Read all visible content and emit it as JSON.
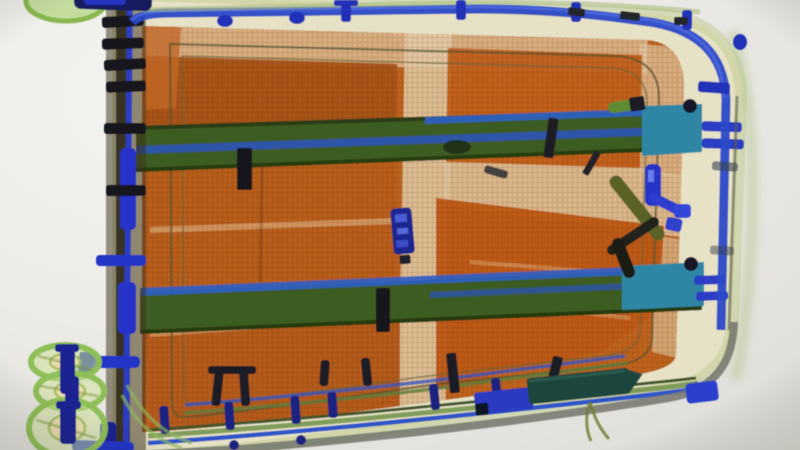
{
  "meta": {
    "scene": "airport-security-xray-baggage-scan",
    "description": "False-color X-ray photograph of a rolling suitcase packed with organic (orange) contents, metal telescopic handle rails, spinner wheels and small metal hardware items",
    "visible_text": []
  },
  "palette": {
    "background": "#edecea",
    "shell_beige": "#e7e2c6",
    "organic_orange": "#c0631f",
    "organic_orange_dark": "#a85418",
    "organic_orange_bright": "#bf5a16",
    "band_light": "#e2cba6",
    "rail_green": "#3e5c20",
    "rail_teal": "#2f86a4",
    "metal_blue": "#2b3fd0",
    "piping_blue": "#2c49c8",
    "hardware_dark": "#17171f",
    "wheel_green": "#8fbf58",
    "wheel_hub": "#e9ddae",
    "rim_gray": "#74746c",
    "blade_green": "#1c453c",
    "tool_navy": "#1d2890"
  },
  "objects": {
    "suitcase_shell": "suitcase shell outline",
    "organic_blocks": "packed clothing (organic orange)",
    "handle_rail_upper": "telescopic handle rail (upper)",
    "handle_rail_lower": "telescopic handle rail (lower)",
    "spinner_wheels": "spinner wheels with axles",
    "multi_tool": "small metal multi-tool",
    "valve_tool": "blue metal fitting tool",
    "knife_object": "dark elongated blade object",
    "hardware": "screws, rivets and clips"
  }
}
